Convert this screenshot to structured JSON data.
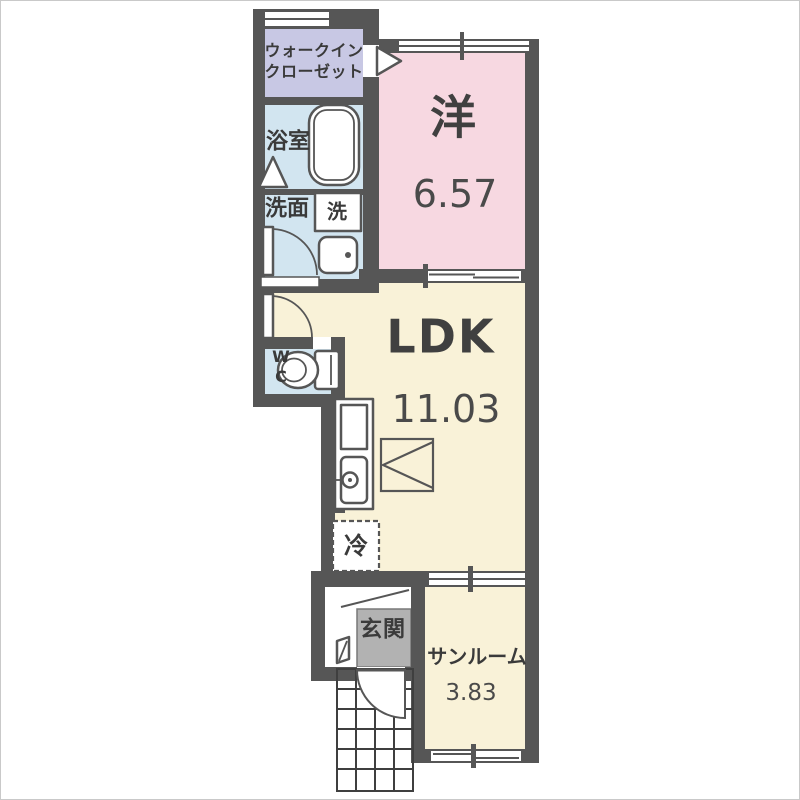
{
  "floorplan": {
    "colors": {
      "wall": "#565656",
      "walk_in_closet": "#c8c8e4",
      "bathroom": "#d2e5f0",
      "washroom": "#d2e5f0",
      "western_room": "#f7d8e1",
      "ldk": "#f9f2d8",
      "toilet_room": "#d2e5f0",
      "sunroom": "#f9f2d8",
      "entrance": "#b2b2b2",
      "background": "#ffffff"
    },
    "rooms": {
      "walk_in_closet": {
        "name_line1": "ウォークイン",
        "name_line2": "クローゼット"
      },
      "bathroom": {
        "name": "浴室"
      },
      "washroom": {
        "name": "洗面"
      },
      "washing_machine": {
        "name": "洗"
      },
      "western_room": {
        "name": "洋",
        "area": "6.57"
      },
      "toilet": {
        "name_line1": "W",
        "name_line2": "C"
      },
      "ldk": {
        "name": "LDK",
        "area": "11.03"
      },
      "refrigerator": {
        "name": "冷"
      },
      "entrance": {
        "name": "玄関"
      },
      "sunroom": {
        "name": "サンルーム",
        "area": "3.83"
      }
    }
  }
}
